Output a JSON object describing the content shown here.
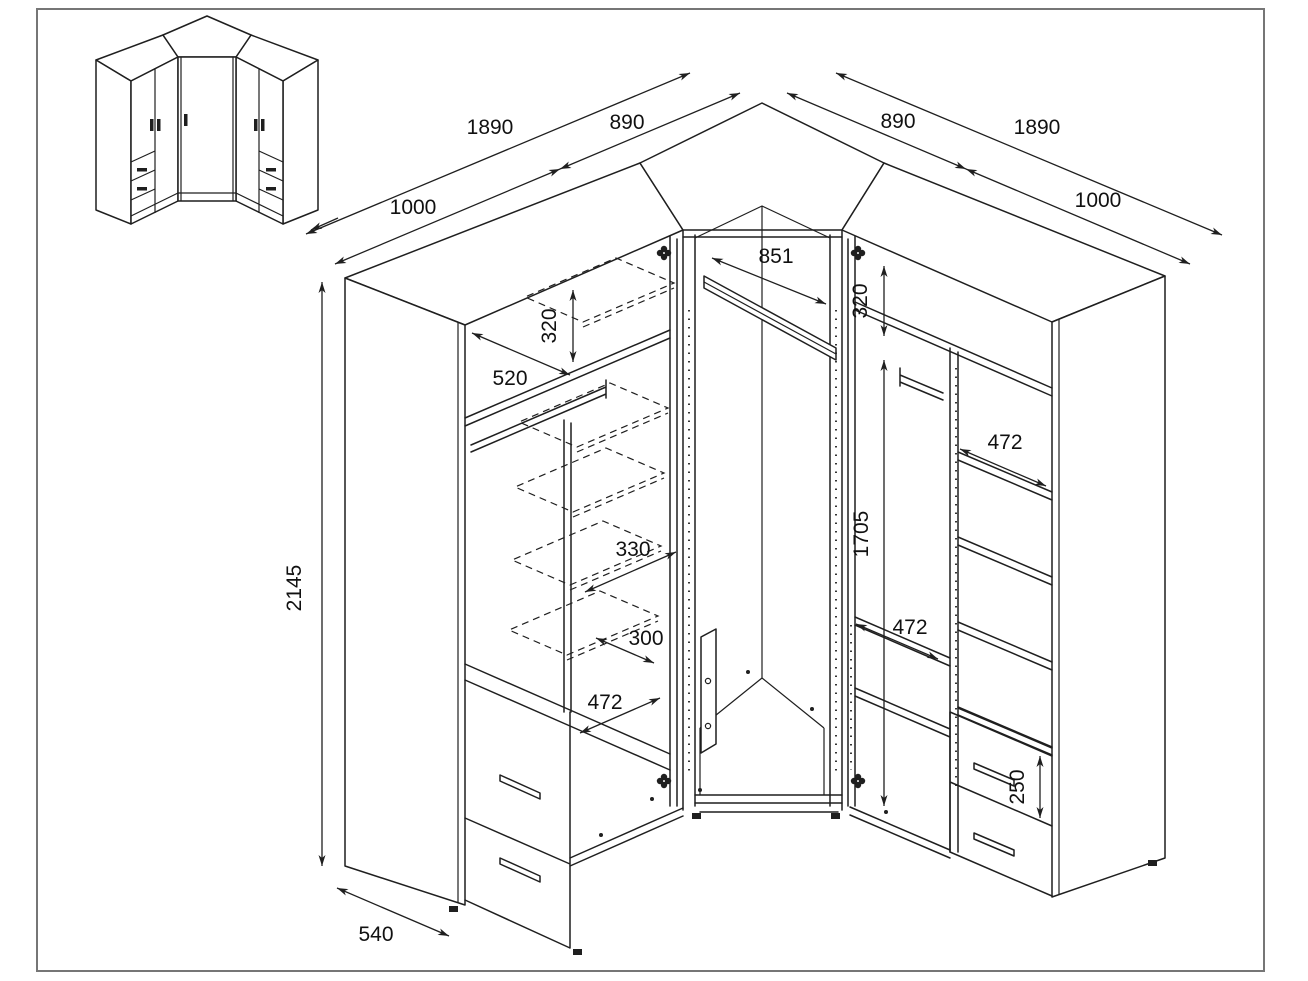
{
  "drawing": {
    "type": "corner-wardrobe technical dimension drawing",
    "units": "mm",
    "line_color": "#1f1f1f",
    "background": "#ffffff",
    "border_color": "#767676"
  },
  "dimensions": {
    "left_total": "1890",
    "left_wing": "1000",
    "left_corner": "890",
    "right_total": "1890",
    "right_wing": "1000",
    "right_corner": "890",
    "corner_rail": "851",
    "top_offset_left": "320",
    "top_offset_right": "320",
    "rail_depth": "520",
    "shelf_330": "330",
    "shelf_300": "300",
    "shelf_472_left": "472",
    "shelf_472_right_top": "472",
    "shelf_472_right_mid": "472",
    "height_total": "2145",
    "height_interior": "1705",
    "depth_side": "540",
    "drawer_front": "250"
  }
}
